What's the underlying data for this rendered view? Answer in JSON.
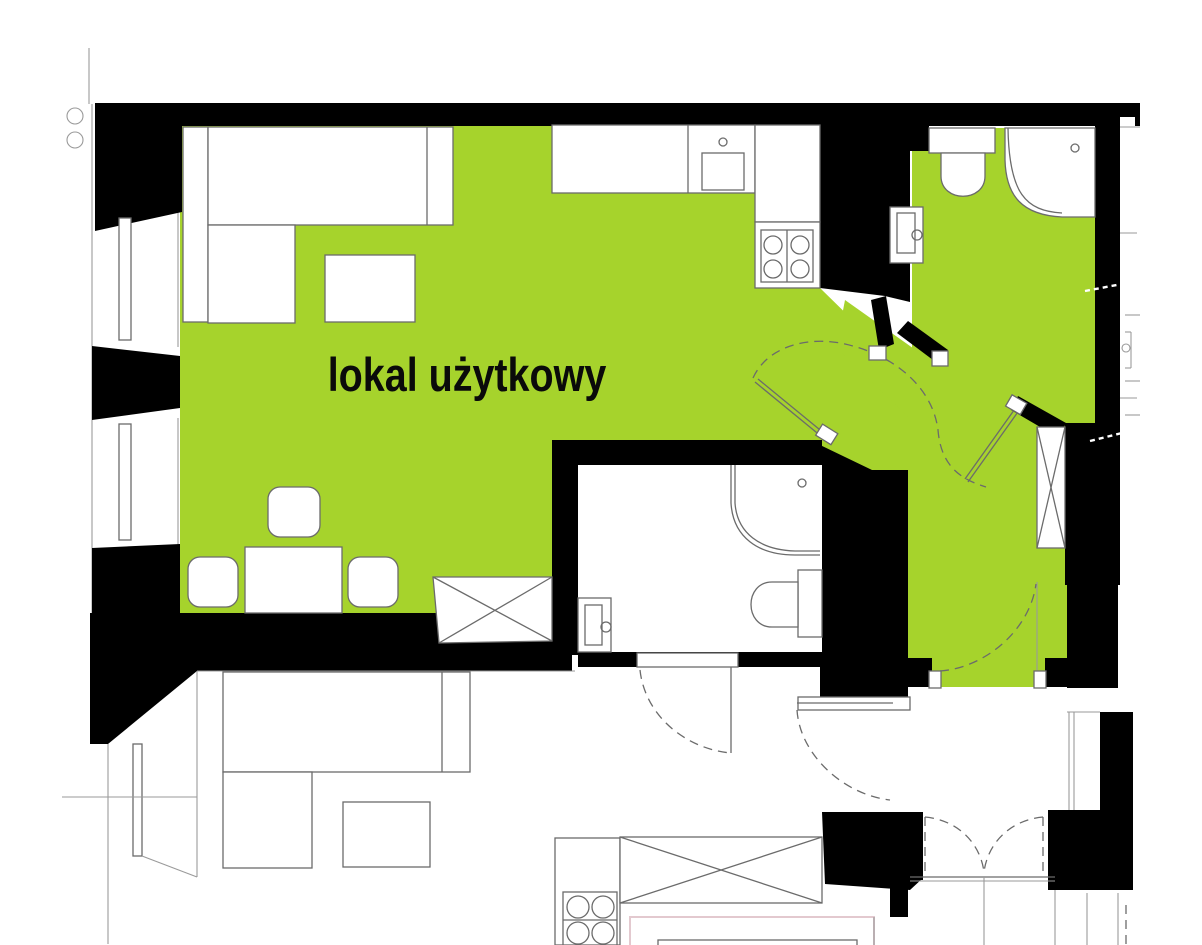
{
  "plan": {
    "label": {
      "text": "lokal użytkowy"
    },
    "colors": {
      "premises": "#a6d32c",
      "walls": "#000000",
      "fixture_line": "#6b6b6b",
      "light_line": "#9a9a9a",
      "accent_faint": "#e3c9cf"
    }
  }
}
